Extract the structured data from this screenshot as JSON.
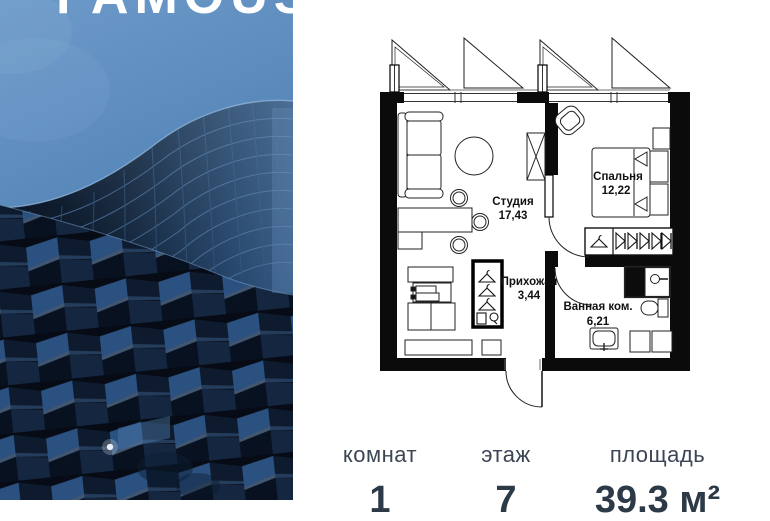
{
  "brand": {
    "logo": "FAMOUS"
  },
  "floorplan": {
    "rooms": [
      {
        "name": "Студия",
        "area": "17,43"
      },
      {
        "name": "Спальня",
        "area": "12,22"
      },
      {
        "name": "Прихожая",
        "area": "3,44"
      },
      {
        "name": "Ванная ком.",
        "area": "6,21"
      }
    ]
  },
  "stats": {
    "items": [
      {
        "label": "комнат",
        "value": "1"
      },
      {
        "label": "этаж",
        "value": "7"
      },
      {
        "label": "площадь",
        "value": "39.3 м²"
      }
    ]
  },
  "colors": {
    "sky_top": "#6d9aca",
    "sky_bottom": "#3f6a99",
    "building_dark": "#0a1322",
    "facet_blue": "#2b5181",
    "label_color": "#3b4554",
    "value_color": "#2c3947"
  }
}
